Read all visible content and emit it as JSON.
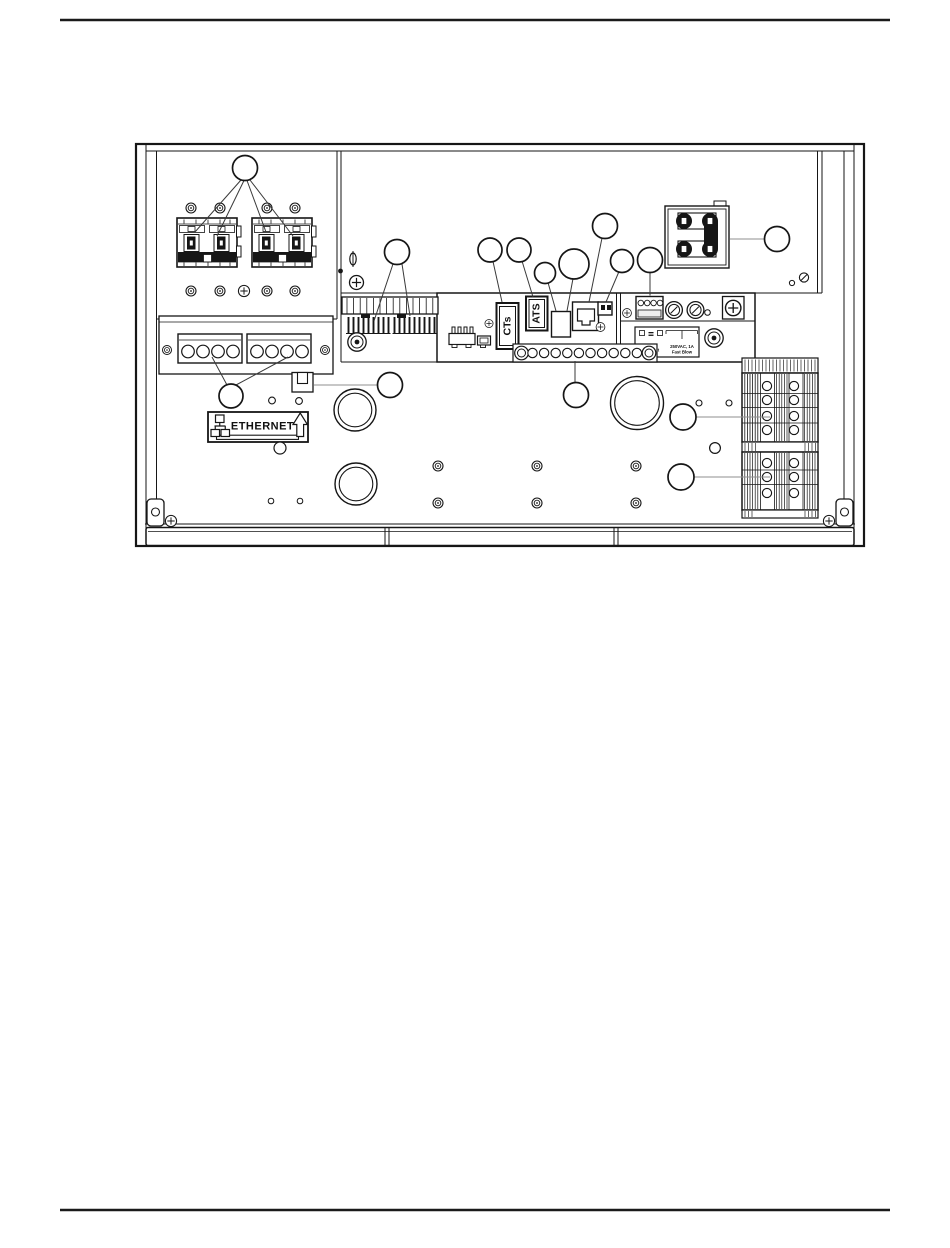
{
  "page": {
    "background": "#ffffff",
    "line_color": "#161616",
    "top_rule": true,
    "bottom_rule": true
  },
  "figure": {
    "description_note": "",
    "connector_labels": {
      "cts": "CTs",
      "ats": "ATS"
    },
    "ethernet_label": {
      "text": "ETHERNET"
    },
    "fuse_plate": {
      "line1": "Gen Inhibit",
      "line2": "250VAC, 1A",
      "line3": "Fast Blow"
    },
    "icons": {
      "ethernet_icon": "network-nodes",
      "arrow_icon": "up-arrow"
    }
  }
}
